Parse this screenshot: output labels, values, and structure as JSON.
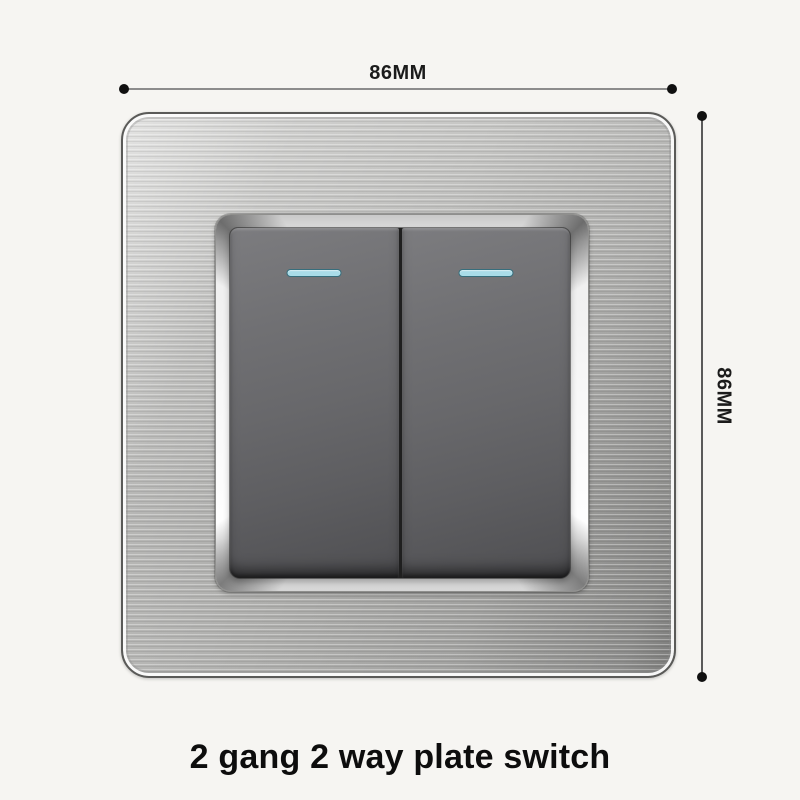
{
  "caption": {
    "text": "2 gang 2 way plate switch"
  },
  "dimensions": {
    "width": {
      "label": "86MM"
    },
    "height": {
      "label": "86MM"
    }
  },
  "switch": {
    "gang_count": 2,
    "indicators_per_rocker": 1,
    "colors": {
      "plate_steel": "#b4b4b2",
      "chrome_frame": "#f5f5f5",
      "rocker": "#6b6b6d",
      "indicator": "#a9dce8",
      "background": "#f6f5f2",
      "caption_text": "#0d0d0d"
    }
  }
}
